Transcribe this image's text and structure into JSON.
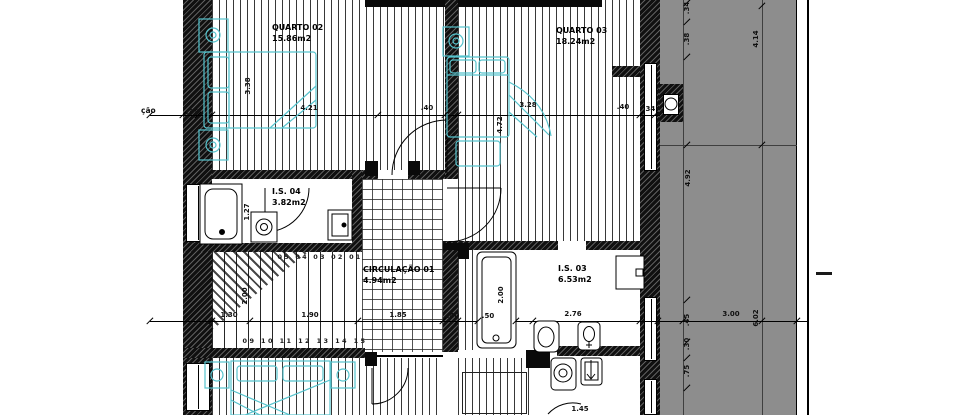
{
  "plan": {
    "type": "architectural-floor-plan",
    "left_partial_label": "ção",
    "rooms": [
      {
        "name": "QUARTO 02",
        "area": "15.86m2"
      },
      {
        "name": "QUARTO 03",
        "area": "18.24m2"
      },
      {
        "name": "I.S. 04",
        "area": "3.82m2"
      },
      {
        "name": "CIRCULAÇÃO 01",
        "area": "4.94m2"
      },
      {
        "name": "I.S. 03",
        "area": "6.53m2"
      }
    ],
    "stairs": {
      "upper_run_numbers": "05 04 03 02 01",
      "lower_run_numbers": "09 10 11 12 13 14 15"
    },
    "dimensions": [
      {
        "text": ".35",
        "x": 192,
        "y": 112,
        "v": false
      },
      {
        "text": "4.21",
        "x": 309,
        "y": 108,
        "v": false
      },
      {
        "text": ".40",
        "x": 427,
        "y": 108,
        "v": false
      },
      {
        "text": "3.28",
        "x": 528,
        "y": 105,
        "v": false
      },
      {
        "text": ".40",
        "x": 623,
        "y": 107,
        "v": false
      },
      {
        "text": ".34",
        "x": 649,
        "y": 109,
        "v": false
      },
      {
        "text": "3.38",
        "x": 248,
        "y": 86,
        "v": true
      },
      {
        "text": "4.72",
        "x": 500,
        "y": 125,
        "v": true
      },
      {
        "text": "1.27",
        "x": 247,
        "y": 212,
        "v": true
      },
      {
        "text": "2.00",
        "x": 245,
        "y": 296,
        "v": true
      },
      {
        "text": "2.00",
        "x": 501,
        "y": 295,
        "v": true
      },
      {
        "text": "1.30",
        "x": 229,
        "y": 315,
        "v": false
      },
      {
        "text": "1.90",
        "x": 310,
        "y": 315,
        "v": false
      },
      {
        "text": "1.85",
        "x": 398,
        "y": 315,
        "v": false
      },
      {
        "text": ".40",
        "x": 453,
        "y": 316,
        "v": false
      },
      {
        "text": ".50",
        "x": 488,
        "y": 316,
        "v": false
      },
      {
        "text": "2.76",
        "x": 573,
        "y": 314,
        "v": false
      },
      {
        "text": "3.00",
        "x": 731,
        "y": 314,
        "v": false
      },
      {
        "text": "6.02",
        "x": 756,
        "y": 318,
        "v": true
      },
      {
        "text": ".34",
        "x": 687,
        "y": 8,
        "v": true
      },
      {
        "text": ".38",
        "x": 687,
        "y": 39,
        "v": true
      },
      {
        "text": "4.14",
        "x": 756,
        "y": 39,
        "v": true
      },
      {
        "text": "4.92",
        "x": 688,
        "y": 178,
        "v": true
      },
      {
        "text": ".45",
        "x": 687,
        "y": 320,
        "v": true
      },
      {
        "text": ".30",
        "x": 687,
        "y": 344,
        "v": true
      },
      {
        "text": ".75",
        "x": 687,
        "y": 371,
        "v": true
      },
      {
        "text": "1.45",
        "x": 580,
        "y": 409,
        "v": false
      }
    ],
    "colors": {
      "wall": "#111111",
      "furniture_outline": "#55c3cd",
      "terrace_fill": "#8d8d8d",
      "paper": "#ffffff",
      "dimension_text": "#111111"
    }
  }
}
